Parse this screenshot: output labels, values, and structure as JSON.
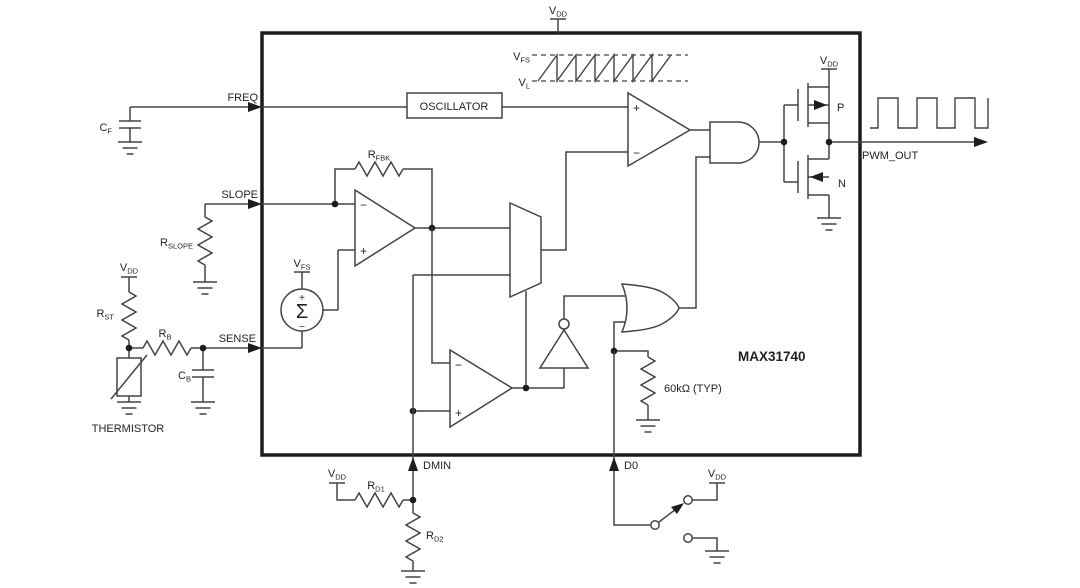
{
  "chip_label": "MAX31740",
  "pins": {
    "freq": "FREQ",
    "slope": "SLOPE",
    "sense": "SENSE",
    "dmin": "DMIN",
    "d0": "D0",
    "pwm_out": "PWM_OUT"
  },
  "net_labels": {
    "vdd": {
      "base": "V",
      "sub": "DD"
    },
    "vfs": {
      "base": "V",
      "sub": "FS"
    },
    "vl": {
      "base": "V",
      "sub": "L"
    }
  },
  "components": {
    "cf": {
      "base": "C",
      "sub": "F"
    },
    "rslope": {
      "base": "R",
      "sub": "SLOPE"
    },
    "rst": {
      "base": "R",
      "sub": "ST"
    },
    "rb": {
      "base": "R",
      "sub": "B"
    },
    "cb": {
      "base": "C",
      "sub": "B"
    },
    "rfbk": {
      "base": "R",
      "sub": "FBK"
    },
    "rd1": {
      "base": "R",
      "sub": "D1"
    },
    "rd2": {
      "base": "R",
      "sub": "D2"
    },
    "thermistor": "THERMISTOR",
    "pullup_value": "60kΩ (TYP)",
    "p_fet": "P",
    "n_fet": "N"
  },
  "blocks": {
    "oscillator": "OSCILLATOR",
    "summer": "Σ"
  },
  "signs": {
    "plus": "+",
    "minus": "−"
  },
  "colors": {
    "wire": "#434343",
    "text": "#231f20",
    "border": "#1c1c1c",
    "background": "#ffffff"
  }
}
